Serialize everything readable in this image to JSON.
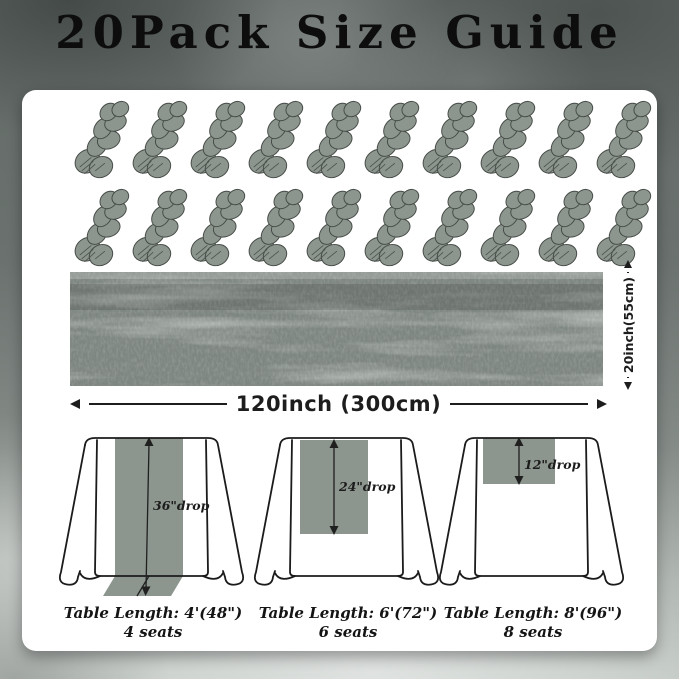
{
  "title": "20Pack Size Guide",
  "pack": {
    "count": 20,
    "per_row": 10,
    "item": "gray cheesecloth table runner bundle"
  },
  "runner_photo": {
    "length_label": "120inch (300cm)",
    "width_label": "20inch(55cm)"
  },
  "tables": [
    {
      "drop_label": "36\"drop",
      "length_label": "Table Length: 4'(48\")",
      "seats_label": "4 seats"
    },
    {
      "drop_label": "24\"drop",
      "length_label": "Table Length: 6'(72\")",
      "seats_label": "6 seats"
    },
    {
      "drop_label": "12\"drop",
      "length_label": "Table Length: 8'(96\")",
      "seats_label": "8 seats"
    }
  ],
  "colors": {
    "fabric": "#8c958e",
    "fabric_dark": "#7e8681",
    "outline": "#1b1b1b",
    "card": "#ffffff",
    "title_text": "#0d0d0d",
    "dimension_text": "#1d1d1d"
  }
}
